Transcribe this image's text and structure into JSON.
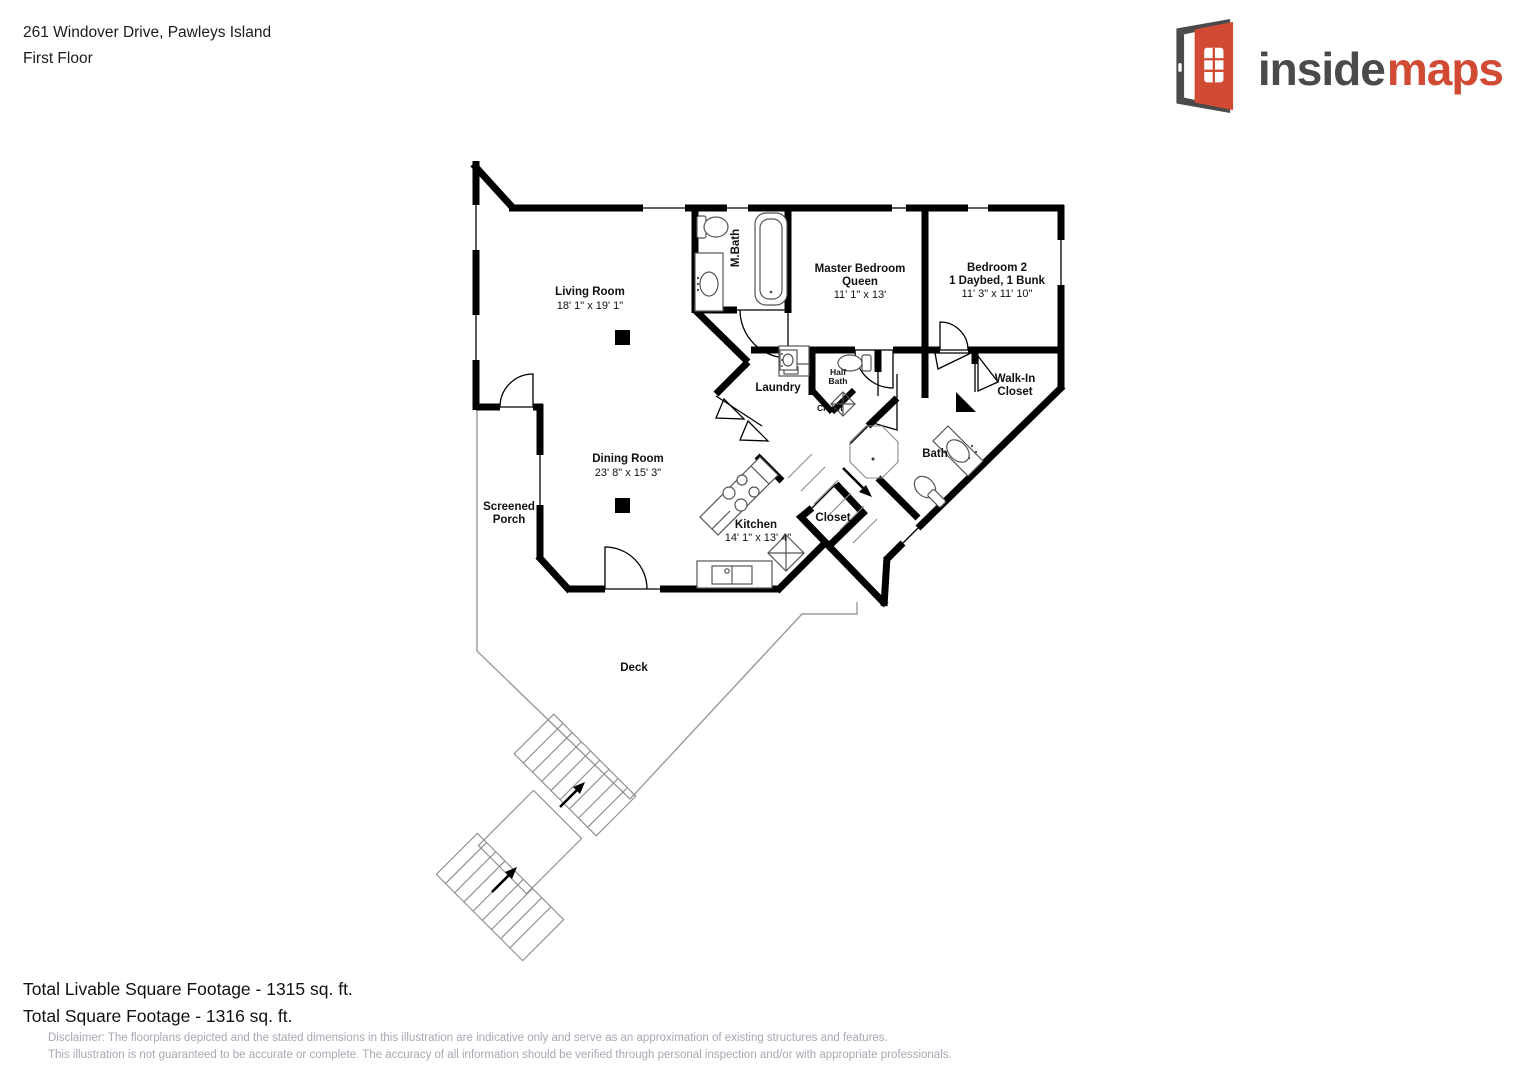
{
  "header": {
    "address": "261 Windover Drive, Pawleys Island",
    "floor_label": "First Floor"
  },
  "logo": {
    "word_dark": "inside",
    "word_accent": "maps",
    "color_dark": "#4a4a4c",
    "color_accent": "#d14a33"
  },
  "plan": {
    "labels": {
      "living_name": "Living Room",
      "living_dims": "18' 1\" x 19' 1\"",
      "dining_name": "Dining Room",
      "dining_dims": "23' 8\" x 15' 3\"",
      "kitchen_name": "Kitchen",
      "kitchen_dims": "14' 1\" x 13' 4\"",
      "master_name": "Master Bedroom",
      "master_sub": "Queen",
      "master_dims": "11' 1\" x 13'",
      "bedroom2_name": "Bedroom 2",
      "bedroom2_sub": "1 Daybed, 1 Bunk",
      "bedroom2_dims": "11' 3\" x 11' 10\"",
      "mbath": "M.Bath",
      "laundry": "Laundry",
      "half_bath_line1": "Half",
      "half_bath_line2": "Bath",
      "closet_hall": "Closet",
      "closet_kitchen": "Closet",
      "walkin_line1": "Walk-In",
      "walkin_line2": "Closet",
      "bath": "Bath",
      "porch_line1": "Screened",
      "porch_line2": "Porch",
      "deck": "Deck"
    }
  },
  "footer": {
    "livable": "Total Livable Square Footage - 1315 sq. ft.",
    "total": "Total Square Footage - 1316 sq. ft.",
    "disclaimer_line1": "Disclaimer: The floorplans depicted and the stated dimensions in this illustration are indicative only and serve as an approximation of existing structures and features.",
    "disclaimer_line2": "This illustration is not guaranteed to be accurate or complete. The accuracy of all information should be verified through personal inspection and/or with appropriate professionals."
  }
}
